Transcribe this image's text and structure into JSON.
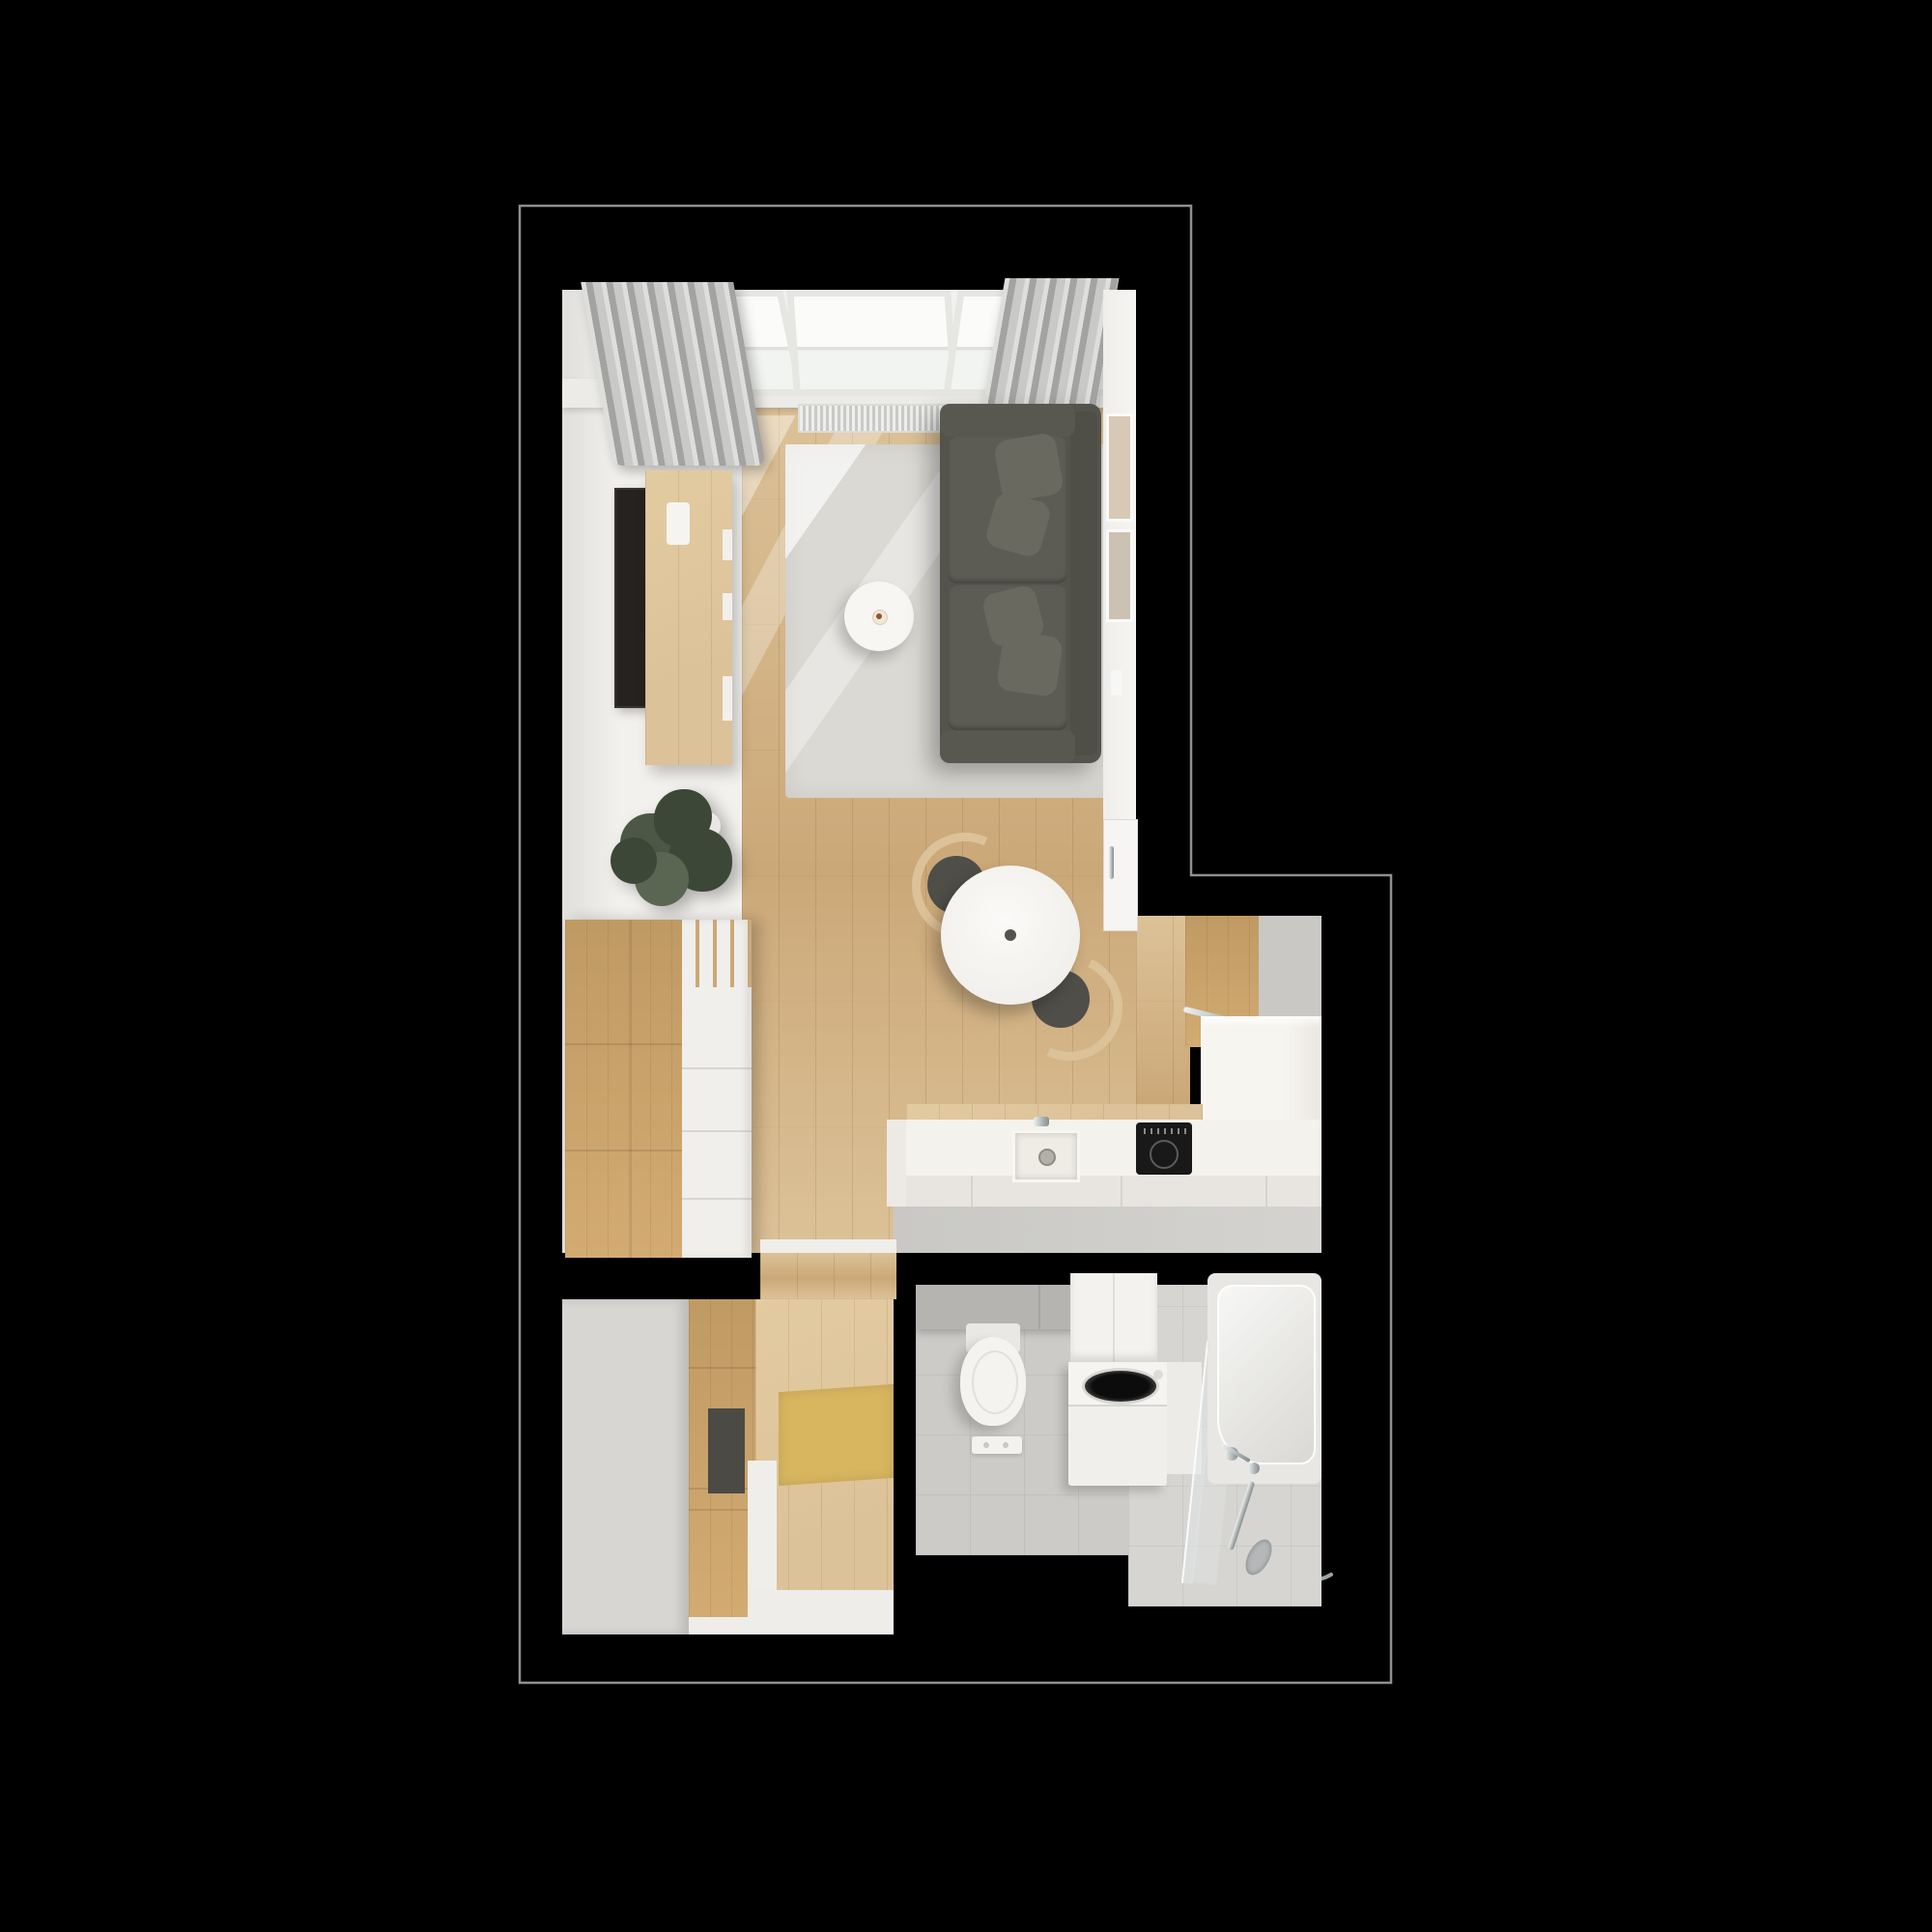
{
  "scene": {
    "label": "top-down 3d render of a small studio apartment floor plan on black background",
    "view": "top-down interior render",
    "text_content": "none (image contains no visible text)"
  },
  "palette": {
    "bg": "#000000",
    "outline": "#8f8f8f",
    "wall": "#f2f1ee",
    "wall-dim": "#e3e1dd",
    "wood": "#cba878",
    "wood-dark": "#c09a63",
    "wood-light": "#dcc298",
    "rug": "#dbd9d4",
    "sofa": "#54534c",
    "sofa-seat": "#5d5c54",
    "sofa-pillow": "#6a695f",
    "curtain-a": "#c9c9c7",
    "curtain-b": "#a3a3a1",
    "grey-floor": "#c9c8c5",
    "counter": "#f4f2ed",
    "counter-face": "#e8e5e0",
    "cooktop": "#191919",
    "chrome": "#aab0b1",
    "tv": "#262220",
    "plant-dark": "#3d4738",
    "plant-mid": "#4c5845",
    "plant-light": "#5a6651",
    "chest-white": "#f1efeb",
    "closet-grey": "#d7d6d3",
    "mat": "#d8b660",
    "niche": "#4b4a44",
    "bath-floor": "#cccbc8",
    "bath-floor-light": "#d6d5d2",
    "tile": "#b5b4b1",
    "fixture": "#f3f2ef"
  },
  "rooms": [
    {
      "id": "living-room",
      "label": "Living room with roof windows, sofa, rug, coffee table, TV sideboard, plant, drawer chest and dining table",
      "items": [
        "roof-window",
        "curtain",
        "radiator",
        "tv",
        "tv-sideboard",
        "rug",
        "coffee-table",
        "coffee-cup",
        "sofa",
        "potted-plant",
        "drawer-chest",
        "wall-art",
        "entry-door",
        "light-switch",
        "dining-table",
        "dining-chair"
      ]
    },
    {
      "id": "kitchen",
      "label": "Open kitchen with L-shaped white counter, sink, induction cooktop and tall wooden cabinet",
      "items": [
        "tall-cabinet",
        "cabinet-rail",
        "counter",
        "sink",
        "faucet",
        "induction-cooktop"
      ]
    },
    {
      "id": "hallway",
      "label": "Hallway with grey closet, wooden wardrobe niche and yellow doormat",
      "items": [
        "closet",
        "wardrobe",
        "bench-niche",
        "doormat",
        "threshold"
      ]
    },
    {
      "id": "bathroom",
      "label": "Bathroom with wall-hung toilet, flush plate, top-loading washing machine, glass screen and bathtub with hand shower",
      "items": [
        "toilet",
        "flush-plate",
        "storage-cabinet",
        "washing-machine",
        "shower-screen",
        "bathtub",
        "hand-shower",
        "shower-bar"
      ]
    }
  ]
}
